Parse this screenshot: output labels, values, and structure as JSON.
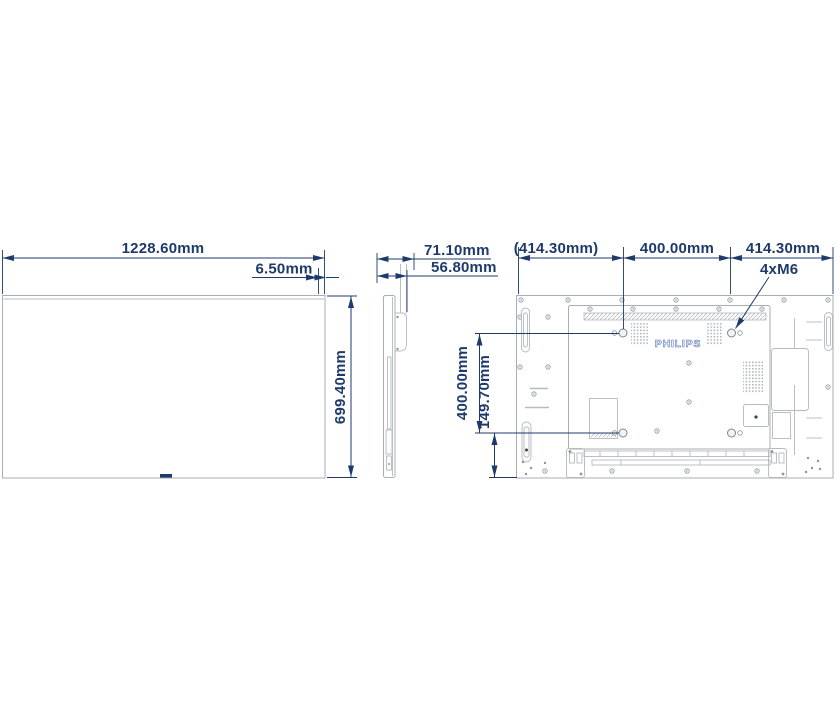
{
  "views": {
    "front": {
      "width": "1228.60mm",
      "bezel": "6.50mm",
      "height": "699.40mm"
    },
    "side": {
      "depth_total": "71.10mm",
      "depth_body": "56.80mm"
    },
    "rear": {
      "left_offset": "(414.30mm)",
      "vesa_width": "400.00mm",
      "right_offset": "414.30mm",
      "mount_screws": "4xM6",
      "vesa_height": "400.00mm",
      "bottom_offset": "149.70mm",
      "brand": "PHILIPS"
    }
  },
  "colors": {
    "dimension": "#1d3a6b",
    "outline": "#a8aeb5",
    "brand": "#4668b8"
  }
}
